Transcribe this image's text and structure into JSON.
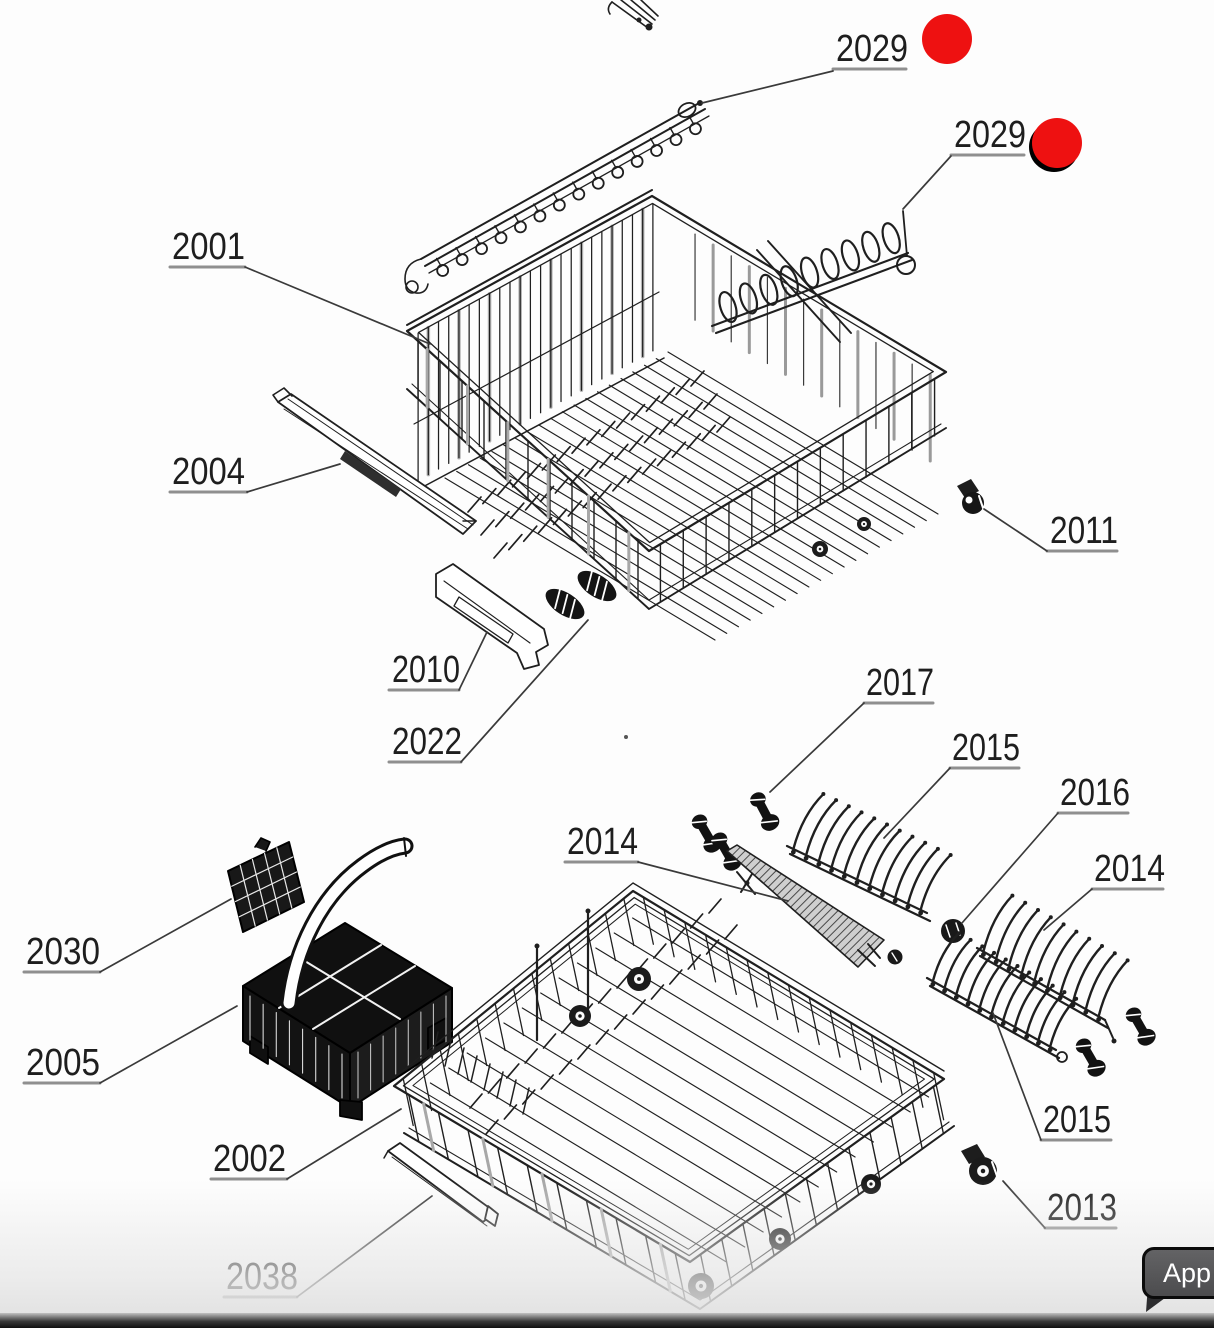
{
  "colors": {
    "ink": "#1f1f1f",
    "underline": "#8f8f8f",
    "leader": "#3a3a3a",
    "marker": "#ee1111",
    "background": "#fdfdfd"
  },
  "app_button": {
    "label": "App"
  },
  "labels": [
    {
      "id": "2029-top",
      "text": "2029",
      "x": 836,
      "w": 72,
      "underline": {
        "x1": 833,
        "x2": 906,
        "y": 69
      },
      "leader": [
        [
          833,
          71
        ],
        [
          702,
          103
        ]
      ]
    },
    {
      "id": "2029-right",
      "text": "2029",
      "x": 954,
      "w": 72,
      "underline": {
        "x1": 951,
        "x2": 1024,
        "y": 155
      },
      "leader": [
        [
          951,
          156
        ],
        [
          903,
          209
        ]
      ]
    },
    {
      "id": "2001",
      "text": "2001",
      "x": 172,
      "w": 73,
      "underline": {
        "x1": 170,
        "x2": 245,
        "y": 267
      },
      "leader": [
        [
          245,
          267
        ],
        [
          430,
          344
        ]
      ]
    },
    {
      "id": "2004",
      "text": "2004",
      "x": 172,
      "w": 73,
      "underline": {
        "x1": 170,
        "x2": 247,
        "y": 492
      },
      "leader": [
        [
          247,
          492
        ],
        [
          340,
          464
        ]
      ]
    },
    {
      "id": "2011",
      "text": "2011",
      "x": 1050,
      "w": 68,
      "underline": {
        "x1": 1047,
        "x2": 1117,
        "y": 551
      },
      "leader": [
        [
          1047,
          551
        ],
        [
          984,
          509
        ]
      ]
    },
    {
      "id": "2010",
      "text": "2010",
      "x": 392,
      "w": 68,
      "underline": {
        "x1": 389,
        "x2": 459,
        "y": 690
      },
      "leader": [
        [
          459,
          690
        ],
        [
          487,
          632
        ]
      ]
    },
    {
      "id": "2022",
      "text": "2022",
      "x": 392,
      "w": 70,
      "underline": {
        "x1": 389,
        "x2": 461,
        "y": 762
      },
      "leader": [
        [
          461,
          762
        ],
        [
          588,
          620
        ]
      ]
    },
    {
      "id": "2017",
      "text": "2017",
      "x": 866,
      "w": 68,
      "underline": {
        "x1": 864,
        "x2": 933,
        "y": 703
      },
      "leader": [
        [
          864,
          703
        ],
        [
          770,
          792
        ]
      ]
    },
    {
      "id": "2015-upper",
      "text": "2015",
      "x": 952,
      "w": 68,
      "underline": {
        "x1": 950,
        "x2": 1019,
        "y": 768
      },
      "leader": [
        [
          950,
          768
        ],
        [
          884,
          838
        ]
      ]
    },
    {
      "id": "2016",
      "text": "2016",
      "x": 1060,
      "w": 70,
      "underline": {
        "x1": 1058,
        "x2": 1128,
        "y": 813
      },
      "leader": [
        [
          1058,
          813
        ],
        [
          962,
          923
        ]
      ]
    },
    {
      "id": "2014-left",
      "text": "2014",
      "x": 567,
      "w": 71,
      "underline": {
        "x1": 565,
        "x2": 638,
        "y": 862
      },
      "leader": [
        [
          638,
          862
        ],
        [
          788,
          901
        ]
      ]
    },
    {
      "id": "2014-right",
      "text": "2014",
      "x": 1094,
      "w": 71,
      "underline": {
        "x1": 1092,
        "x2": 1163,
        "y": 889
      },
      "leader": [
        [
          1092,
          889
        ],
        [
          1044,
          930
        ]
      ]
    },
    {
      "id": "2030",
      "text": "2030",
      "x": 26,
      "w": 74,
      "underline": {
        "x1": 24,
        "x2": 100,
        "y": 972
      },
      "leader": [
        [
          100,
          972
        ],
        [
          231,
          899
        ]
      ]
    },
    {
      "id": "2005",
      "text": "2005",
      "x": 26,
      "w": 74,
      "underline": {
        "x1": 24,
        "x2": 100,
        "y": 1083
      },
      "leader": [
        [
          100,
          1083
        ],
        [
          237,
          1006
        ]
      ]
    },
    {
      "id": "2015-lower",
      "text": "2015",
      "x": 1043,
      "w": 68,
      "underline": {
        "x1": 1041,
        "x2": 1111,
        "y": 1140
      },
      "leader": [
        [
          1041,
          1140
        ],
        [
          993,
          1013
        ]
      ]
    },
    {
      "id": "2002",
      "text": "2002",
      "x": 213,
      "w": 73,
      "underline": {
        "x1": 211,
        "x2": 287,
        "y": 1179
      },
      "leader": [
        [
          287,
          1179
        ],
        [
          401,
          1109
        ]
      ]
    },
    {
      "id": "2013",
      "text": "2013",
      "x": 1047,
      "w": 70,
      "underline": {
        "x1": 1045,
        "x2": 1116,
        "y": 1228
      },
      "leader": [
        [
          1045,
          1228
        ],
        [
          1003,
          1181
        ]
      ]
    },
    {
      "id": "2038",
      "text": "2038",
      "x": 226,
      "w": 72,
      "underline": {
        "x1": 224,
        "x2": 297,
        "y": 1297
      },
      "leader": [
        [
          297,
          1297
        ],
        [
          432,
          1196
        ]
      ]
    }
  ],
  "markers": [
    {
      "id": "hotspot-2029-top",
      "cx": 947,
      "cy": 39,
      "r": 25,
      "shadow": false
    },
    {
      "id": "hotspot-2029-right",
      "cx": 1057,
      "cy": 143,
      "r": 25,
      "shadow": true
    }
  ]
}
